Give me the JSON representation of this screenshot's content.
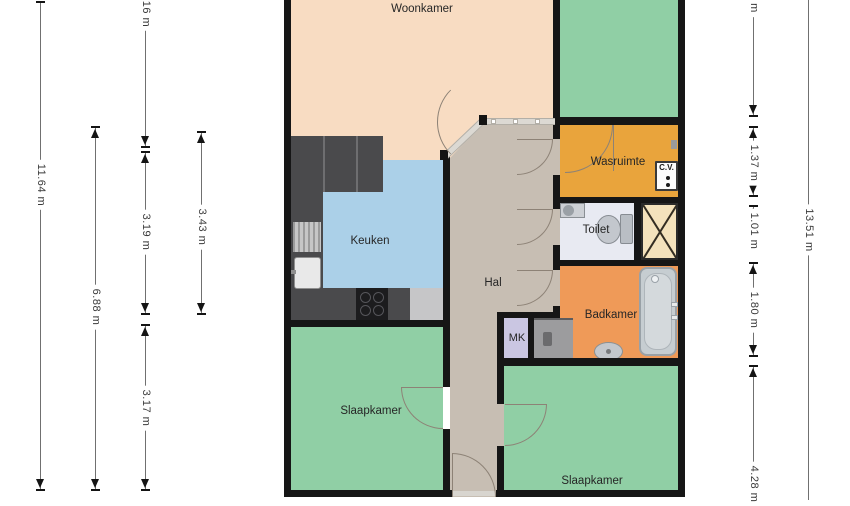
{
  "rooms": {
    "woonkamer": "Woonkamer",
    "keuken": "Keuken",
    "hal": "Hal",
    "wasruimte": "Wasruimte",
    "toilet": "Toilet",
    "badkamer": "Badkamer",
    "mk": "MK",
    "cv": "C.V.",
    "slaapkamer_left": "Slaapkamer",
    "slaapkamer_right": "Slaapkamer"
  },
  "dims": {
    "a": "11.64 m",
    "b": "6.88 m",
    "c1": "16 m",
    "c2": "3.19 m",
    "c3": "3.17 m",
    "d": "3.43 m",
    "e1": "m",
    "e2": "1.37 m",
    "e3": "1.01 m",
    "e4": "1.80 m",
    "e5": "4.28 m",
    "f": "13.51 m"
  },
  "colors": {
    "living_floor": "#f8dcc2",
    "bedroom_floor": "#90cfa5",
    "kitchen_floor": "#abd0e8",
    "hall_floor": "#c7beb3",
    "laundry_floor": "#e9a43c",
    "bathroom_floor": "#ef9a58",
    "toilet_floor": "#e8eaf2",
    "meter_closet": "#cac6e2",
    "shaft": "#f4e2bc",
    "wall": "#161616"
  }
}
